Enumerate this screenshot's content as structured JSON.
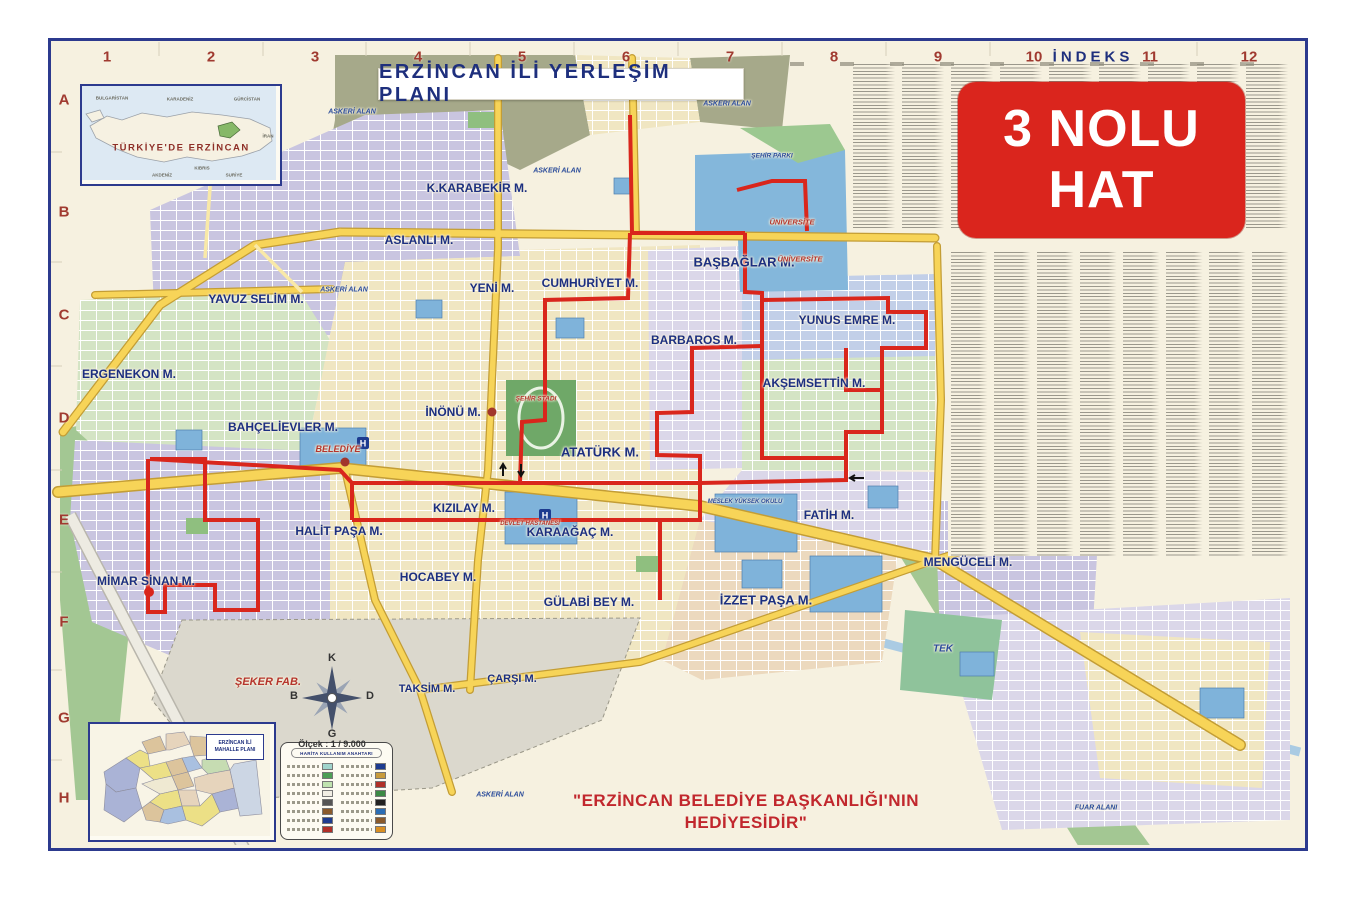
{
  "header": {
    "title": "ERZİNCAN İLİ YERLEŞİM PLANI"
  },
  "badge": {
    "line1": "3 NOLU",
    "line2": "HAT",
    "bg_color": "#da251d",
    "text_color": "#ffffff"
  },
  "index": {
    "title": "İNDEKS"
  },
  "grid": {
    "columns": [
      {
        "text": "1",
        "x": 107,
        "y": 57
      },
      {
        "text": "2",
        "x": 211,
        "y": 57
      },
      {
        "text": "3",
        "x": 315,
        "y": 57
      },
      {
        "text": "4",
        "x": 418,
        "y": 57
      },
      {
        "text": "5",
        "x": 522,
        "y": 57
      },
      {
        "text": "6",
        "x": 626,
        "y": 57
      },
      {
        "text": "7",
        "x": 730,
        "y": 57
      },
      {
        "text": "8",
        "x": 834,
        "y": 57
      },
      {
        "text": "9",
        "x": 938,
        "y": 57
      },
      {
        "text": "10",
        "x": 1034,
        "y": 57
      },
      {
        "text": "11",
        "x": 1150,
        "y": 57
      },
      {
        "text": "12",
        "x": 1249,
        "y": 57
      }
    ],
    "rows": [
      {
        "text": "A",
        "x": 64,
        "y": 100
      },
      {
        "text": "B",
        "x": 64,
        "y": 212
      },
      {
        "text": "C",
        "x": 64,
        "y": 315
      },
      {
        "text": "D",
        "x": 64,
        "y": 418
      },
      {
        "text": "E",
        "x": 64,
        "y": 520
      },
      {
        "text": "F",
        "x": 64,
        "y": 622
      },
      {
        "text": "G",
        "x": 64,
        "y": 718
      },
      {
        "text": "H",
        "x": 64,
        "y": 798
      }
    ]
  },
  "map": {
    "route_color": "#d9261c",
    "neighborhood_labels": [
      {
        "text": "K.KARABEKİR M.",
        "x": 477,
        "y": 188,
        "s": 12
      },
      {
        "text": "ASLANLI M.",
        "x": 419,
        "y": 240,
        "s": 12
      },
      {
        "text": "YENİ M.",
        "x": 492,
        "y": 288,
        "s": 12
      },
      {
        "text": "CUMHURİYET M.",
        "x": 590,
        "y": 283,
        "s": 12
      },
      {
        "text": "BAŞBAĞLAR M.",
        "x": 744,
        "y": 262,
        "s": 13
      },
      {
        "text": "YAVUZ SELİM M.",
        "x": 256,
        "y": 299,
        "s": 12
      },
      {
        "text": "ERGENEKON M.",
        "x": 129,
        "y": 374,
        "s": 12
      },
      {
        "text": "BARBAROS M.",
        "x": 694,
        "y": 340,
        "s": 12
      },
      {
        "text": "YUNUS EMRE M.",
        "x": 847,
        "y": 320,
        "s": 12
      },
      {
        "text": "AKŞEMSETTİN M.",
        "x": 814,
        "y": 383,
        "s": 12
      },
      {
        "text": "İNÖNÜ M.",
        "x": 453,
        "y": 412,
        "s": 12
      },
      {
        "text": "BAHÇELİEVLER M.",
        "x": 283,
        "y": 427,
        "s": 12
      },
      {
        "text": "ATATÜRK M.",
        "x": 600,
        "y": 452,
        "s": 13
      },
      {
        "text": "KIZILAY M.",
        "x": 464,
        "y": 508,
        "s": 12
      },
      {
        "text": "HALİT PAŞA M.",
        "x": 339,
        "y": 531,
        "s": 12
      },
      {
        "text": "KARAAĞAÇ M.",
        "x": 570,
        "y": 532,
        "s": 12
      },
      {
        "text": "FATİH M.",
        "x": 829,
        "y": 515,
        "s": 12
      },
      {
        "text": "MENGÜCELİ M.",
        "x": 968,
        "y": 562,
        "s": 12
      },
      {
        "text": "MİMAR SİNAN M.",
        "x": 146,
        "y": 581,
        "s": 12
      },
      {
        "text": "HOCABEY M.",
        "x": 438,
        "y": 577,
        "s": 12
      },
      {
        "text": "GÜLABİ BEY M.",
        "x": 589,
        "y": 602,
        "s": 12
      },
      {
        "text": "İZZET PAŞA M.",
        "x": 766,
        "y": 600,
        "s": 13
      },
      {
        "text": "TAKSİM M.",
        "x": 427,
        "y": 689,
        "s": 11
      },
      {
        "text": "ÇARŞI M.",
        "x": 512,
        "y": 679,
        "s": 11
      }
    ],
    "area_labels": [
      {
        "text": "ASKERİ ALAN",
        "x": 352,
        "y": 112,
        "s": 7,
        "cls": "lbl-blue-it"
      },
      {
        "text": "ASKERİ ALAN",
        "x": 557,
        "y": 171,
        "s": 7,
        "cls": "lbl-blue-it"
      },
      {
        "text": "ASKERİ ALAN",
        "x": 727,
        "y": 104,
        "s": 7,
        "cls": "lbl-blue-it"
      },
      {
        "text": "ASKERİ ALAN",
        "x": 344,
        "y": 290,
        "s": 7,
        "cls": "lbl-blue-it"
      },
      {
        "text": "ASKERİ ALAN",
        "x": 500,
        "y": 795,
        "s": 7,
        "cls": "lbl-blue-it"
      },
      {
        "text": "ŞEHİR PARKI",
        "x": 772,
        "y": 156,
        "s": 6.5,
        "cls": "lbl-blue-it"
      },
      {
        "text": "ÜNİVERSİTE",
        "x": 792,
        "y": 222,
        "s": 7.5,
        "cls": "lbl-red-it"
      },
      {
        "text": "ÜNİVERSİTE",
        "x": 800,
        "y": 259,
        "s": 7.5,
        "cls": "lbl-red-it"
      },
      {
        "text": "ŞEHİR STADI",
        "x": 536,
        "y": 399,
        "s": 6.5,
        "cls": "lbl-red-it"
      },
      {
        "text": "BELEDİYE",
        "x": 338,
        "y": 449,
        "s": 9,
        "cls": "lbl-red-it"
      },
      {
        "text": "DEVLET HASTANESİ",
        "x": 530,
        "y": 524,
        "s": 6,
        "cls": "lbl-red-it"
      },
      {
        "text": "MESLEK YÜKSEK OKULU",
        "x": 745,
        "y": 502,
        "s": 6,
        "cls": "lbl-blue-it"
      },
      {
        "text": "ŞEKER FAB.",
        "x": 268,
        "y": 682,
        "s": 11,
        "cls": "lbl-red-it"
      },
      {
        "text": "TEK",
        "x": 943,
        "y": 649,
        "s": 10,
        "cls": "lbl-blue-it"
      },
      {
        "text": "FUAR ALANI",
        "x": 1096,
        "y": 808,
        "s": 7,
        "cls": "lbl-blue-it"
      }
    ]
  },
  "insets": {
    "turkey": {
      "label": "TÜRKİYE'DE ERZİNCAN",
      "micro_labels": [
        {
          "text": "BULGARİSTAN",
          "x": 30,
          "y": 12,
          "s": 4.5,
          "cls": "lbl-micro"
        },
        {
          "text": "KARADENİZ",
          "x": 98,
          "y": 13,
          "s": 4.5,
          "cls": "lbl-micro"
        },
        {
          "text": "GÜRCİSTAN",
          "x": 165,
          "y": 13,
          "s": 4.5,
          "cls": "lbl-micro"
        },
        {
          "text": "İRAN",
          "x": 186,
          "y": 50,
          "s": 4.5,
          "cls": "lbl-micro"
        },
        {
          "text": "AKDENİZ",
          "x": 80,
          "y": 89,
          "s": 4.5,
          "cls": "lbl-micro"
        },
        {
          "text": "KIBRIS",
          "x": 120,
          "y": 82,
          "s": 4.5,
          "cls": "lbl-micro"
        },
        {
          "text": "SURİYE",
          "x": 152,
          "y": 89,
          "s": 4.5,
          "cls": "lbl-micro"
        }
      ]
    },
    "mahalle": {
      "label_line1": "ERZİNCAN İLİ",
      "label_line2": "MAHALLE PLANI"
    }
  },
  "legend": {
    "title": "HARİTA KULLANIM ANAHTARI",
    "left_rows": [
      {
        "swatch": "#9fd4cc"
      },
      {
        "swatch": "#4c9f56"
      },
      {
        "swatch": "#bfe3af"
      },
      {
        "swatch": "#f1eee4"
      },
      {
        "swatch": "#555555"
      },
      {
        "swatch": "#8a5a2b"
      },
      {
        "swatch": "#1d3b8f"
      },
      {
        "swatch": "#b03028"
      }
    ],
    "right_rows": [
      {
        "swatch": "#1d3b8f"
      },
      {
        "swatch": "#c89b3c"
      },
      {
        "swatch": "#b03028"
      },
      {
        "swatch": "#3c8a46"
      },
      {
        "swatch": "#222222"
      },
      {
        "swatch": "#2a6db5"
      },
      {
        "swatch": "#8a5a2b"
      },
      {
        "swatch": "#d98f23"
      }
    ]
  },
  "compass": {
    "north": "K",
    "east": "D",
    "south": "G",
    "west": "B",
    "scale": "Ölçek : 1 / 9.000"
  },
  "footer": {
    "line1": "\"ERZİNCAN BELEDİYE BAŞKANLIĞI'NIN",
    "line2": "HEDİYESİDİR\""
  },
  "colors": {
    "frame": "#2c3a8e",
    "paper": "#f6f1e0",
    "route": "#d9261c",
    "main_road": "#f7d458",
    "grid_label": "#a03a30",
    "label_navy": "#1c2f80",
    "military_area": "#a6a98a",
    "institution_blue": "#84b7db",
    "park_green": "#9cc890"
  }
}
